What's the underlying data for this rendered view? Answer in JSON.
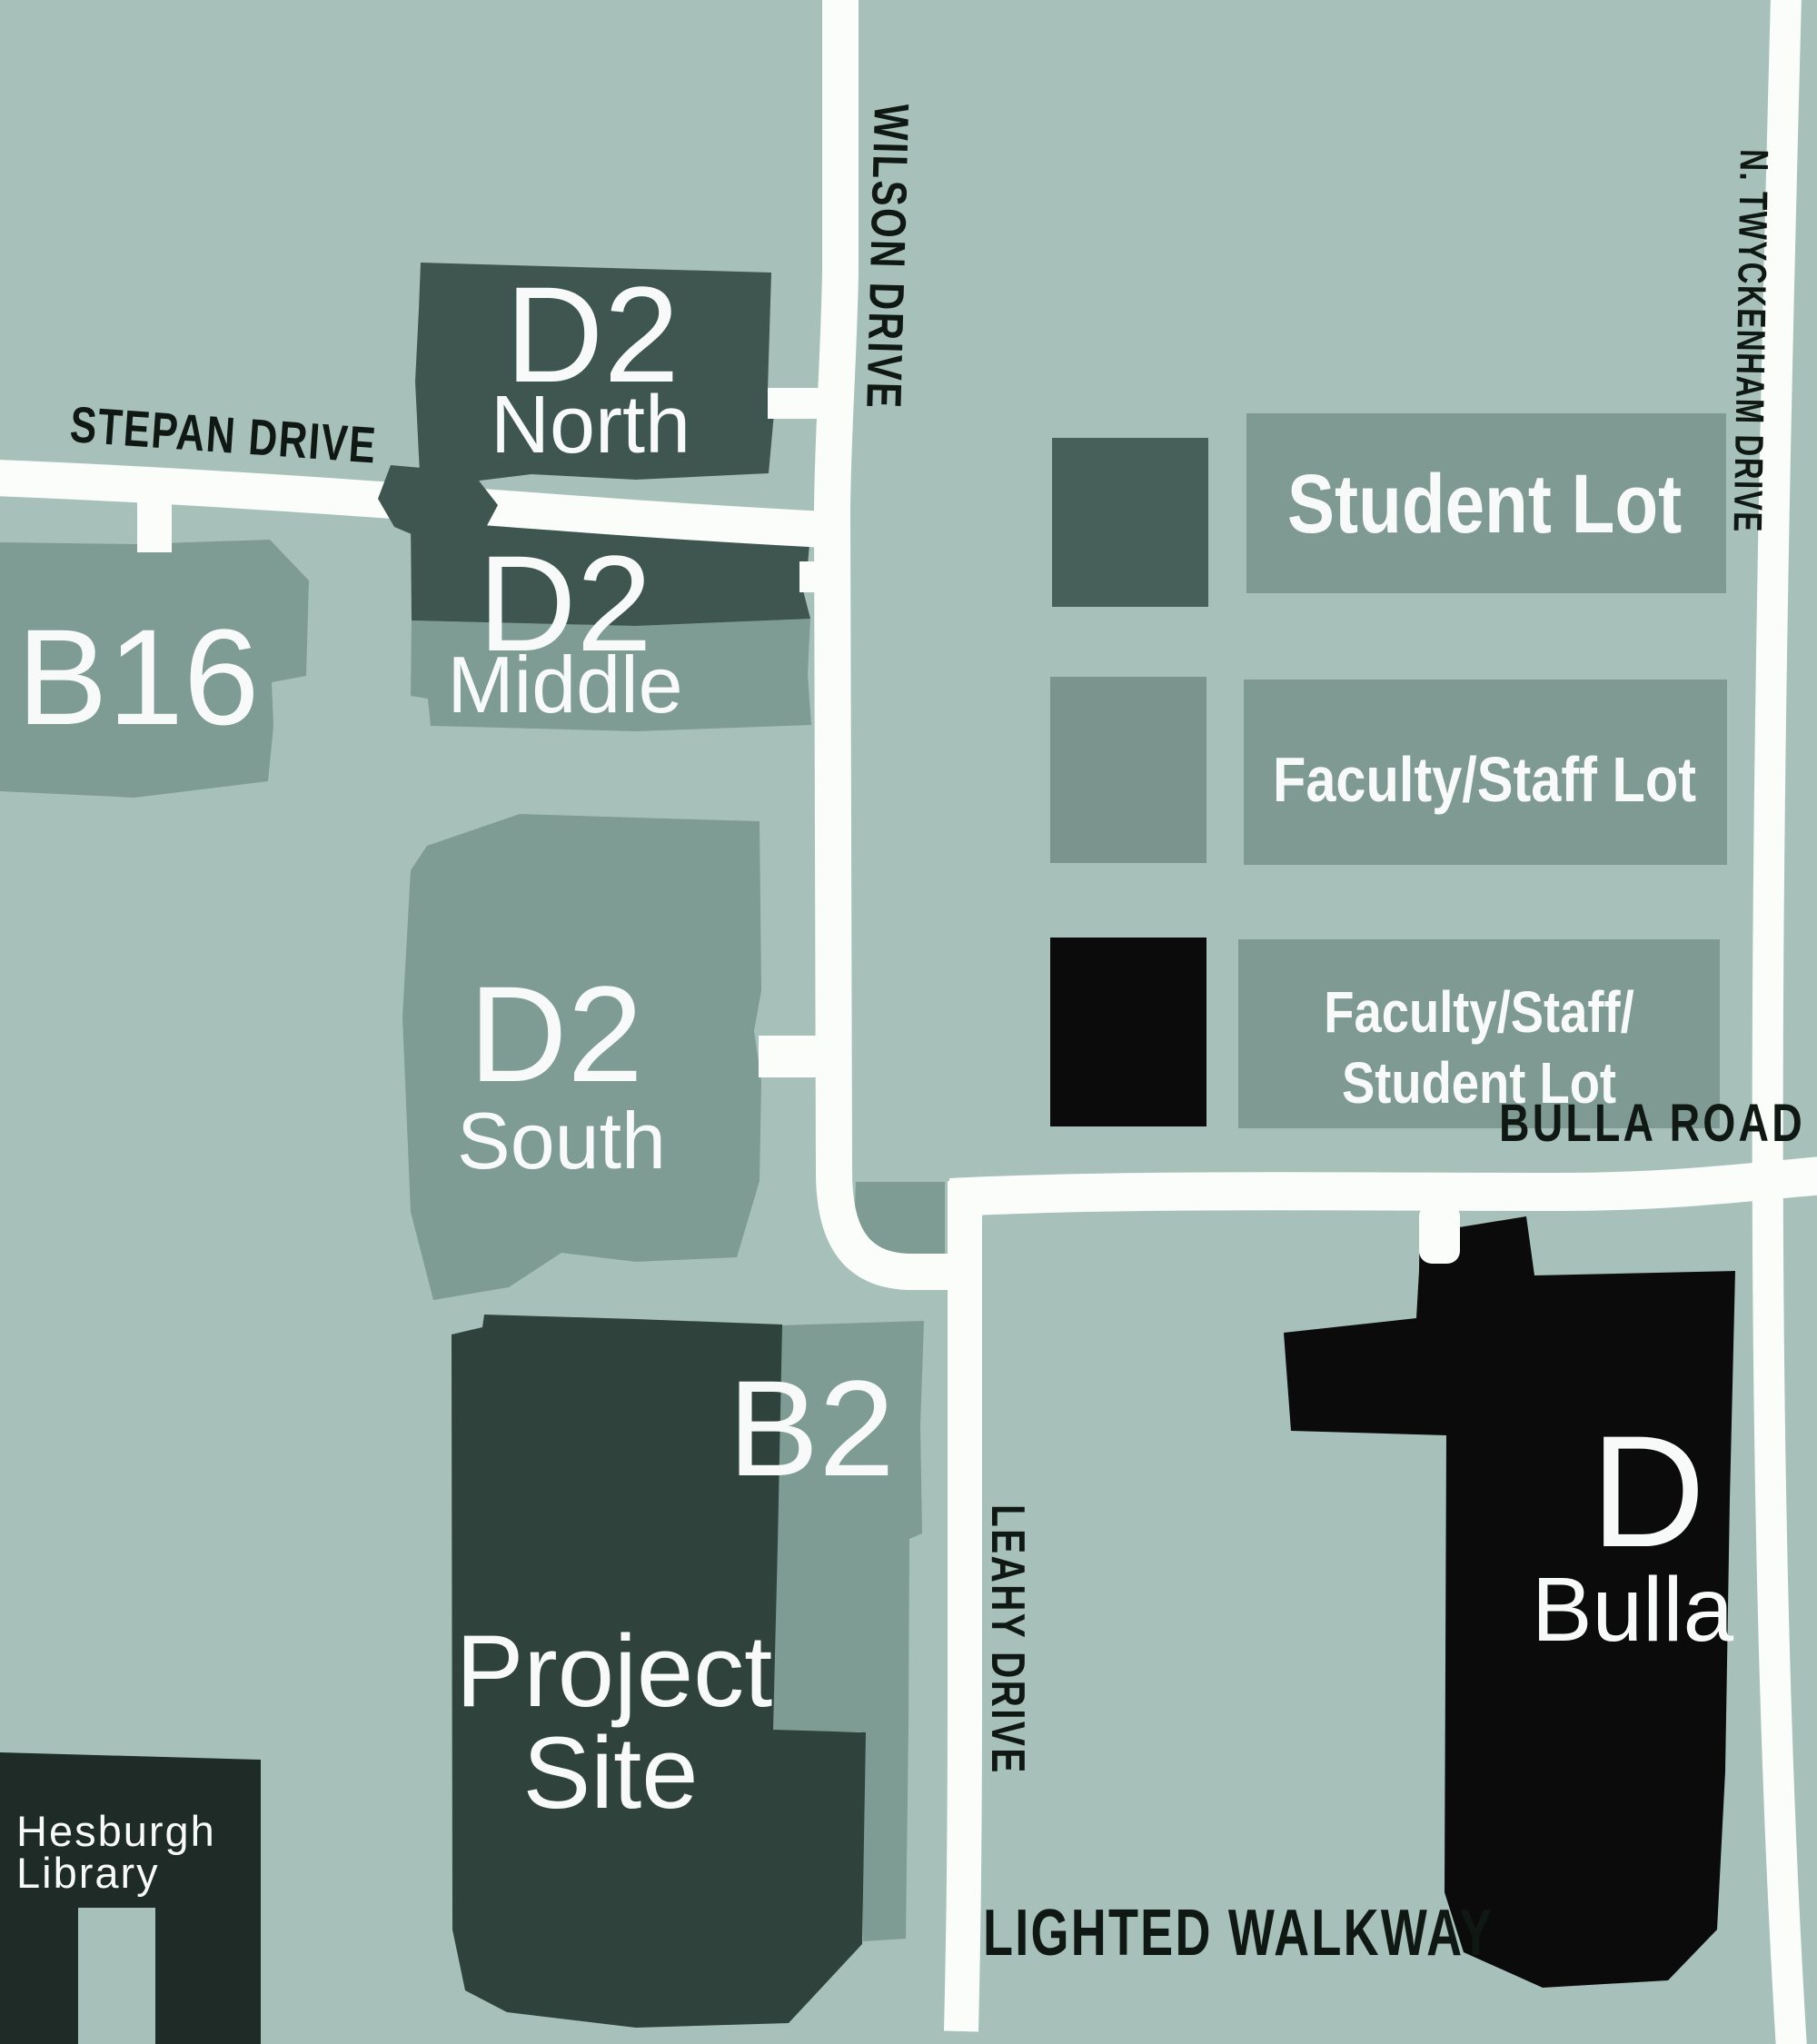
{
  "colors": {
    "background": "#a7c1ba",
    "road": "#fbfdfb",
    "student_lot": "#3e564f",
    "faculty_lot": "#7e9b94",
    "combo_lot": "#0b0b0b",
    "project_site": "#2f423c",
    "building": "#1e2b27",
    "legend_student_swatch": "#47615a",
    "legend_faculty_swatch": "#7c948e",
    "legend_bar": "#7f9a93",
    "road_label": "#101814",
    "lot_label": "#f7faf8"
  },
  "roads": {
    "stepan": "STEPAN DRIVE",
    "wilson": "WILSON DRIVE",
    "twyckenham": "N. TWYCKENHAM DRIVE",
    "bulla": "BULLA ROAD",
    "leahy": "LEAHY DRIVE"
  },
  "walkway": {
    "label": "LIGHTED WALKWAY"
  },
  "lots": {
    "d2_north": {
      "label": "D2",
      "sublabel": "North"
    },
    "d2_middle": {
      "label": "D2",
      "sublabel": "Middle"
    },
    "d2_south": {
      "label": "D2",
      "sublabel": "South"
    },
    "b16": {
      "label": "B16"
    },
    "b2": {
      "label": "B2"
    },
    "project_site": {
      "line1": "Project",
      "line2": "Site"
    },
    "bulla": {
      "label": "D",
      "sublabel": "Bulla"
    },
    "hesburgh": {
      "line1": "Hesburgh",
      "line2": "Library"
    }
  },
  "legend": {
    "student": {
      "label": "Student Lot"
    },
    "faculty": {
      "label": "Faculty/Staff Lot"
    },
    "combo": {
      "line1": "Faculty/Staff/",
      "line2": "Student Lot"
    }
  }
}
